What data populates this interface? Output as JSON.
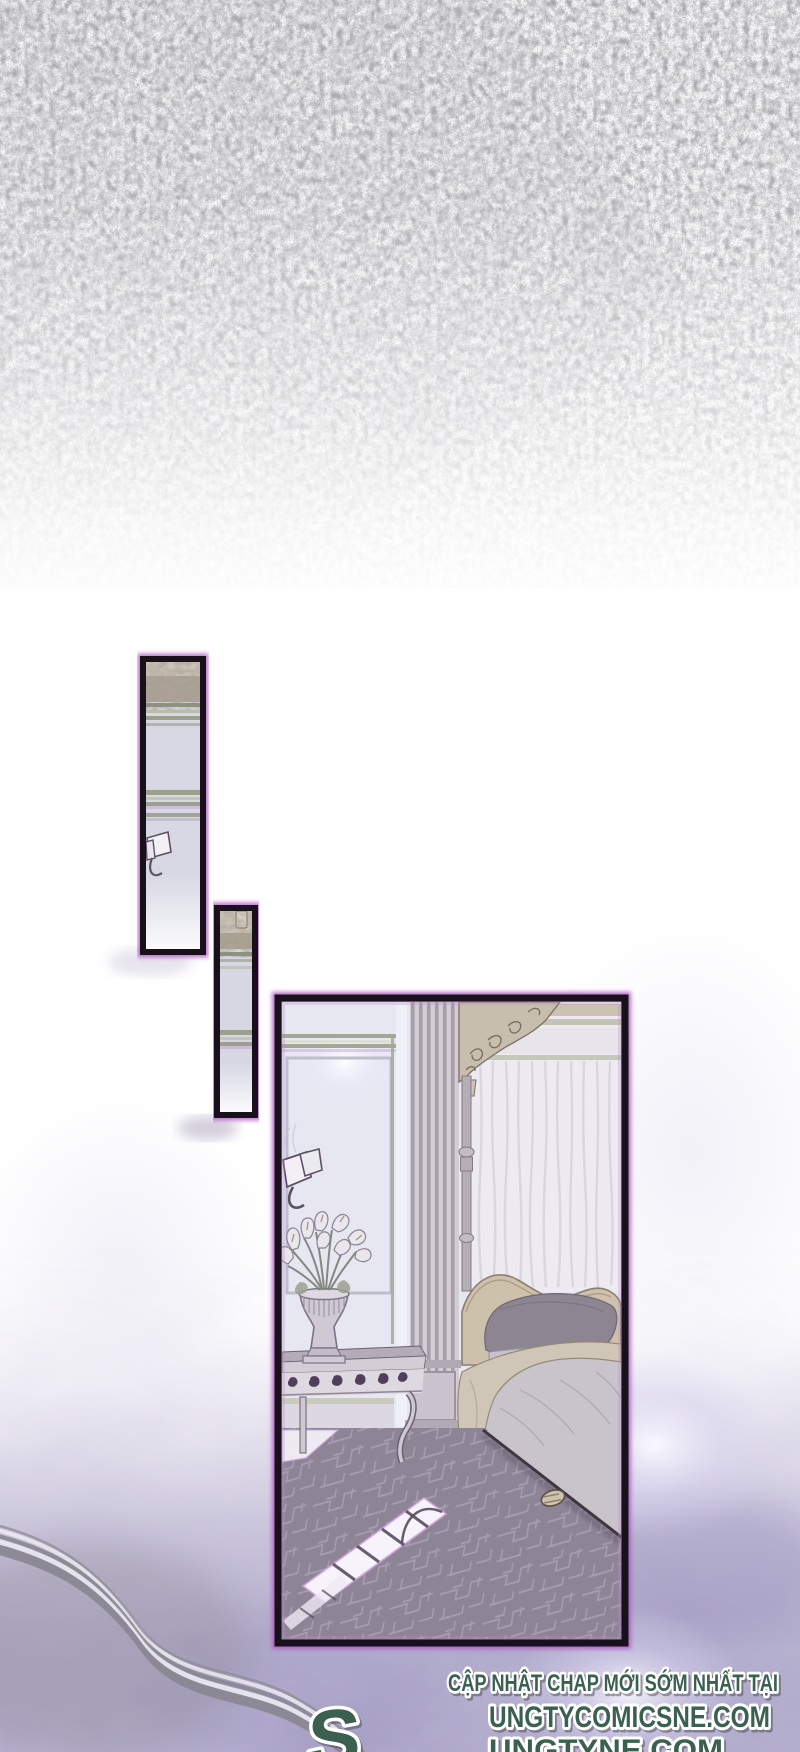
{
  "footer": {
    "promo_text": "CẬP NHẬT CHAP MỚI SỚM NHẤT TẠI",
    "logo_glyph": "S",
    "site_primary": "UNGTYCOMICSNE.COM",
    "site_secondary": "UNGTYNE.COM"
  },
  "artwork": {
    "panel_count": 3,
    "panels": [
      {
        "id": "panel-1",
        "description": "tall sliver panel: wall cornice, moldings and wall sconce"
      },
      {
        "id": "panel-2",
        "description": "narrow sliver panel: cornice and wall moldings"
      },
      {
        "id": "panel-3",
        "description": "bedroom: canopy bed with curtain, console table with lily vase, sunlit patterned carpet, slipper"
      }
    ],
    "colors": {
      "panel_border": "#18111c",
      "panel_glow": "#ae57bf",
      "footer_text": "#3b6150",
      "footer_outline": "#ffffff",
      "carpet": "#8d8595",
      "cloud_purple": "#a49dc4",
      "wall_lavender": "#e7e7f2"
    }
  }
}
